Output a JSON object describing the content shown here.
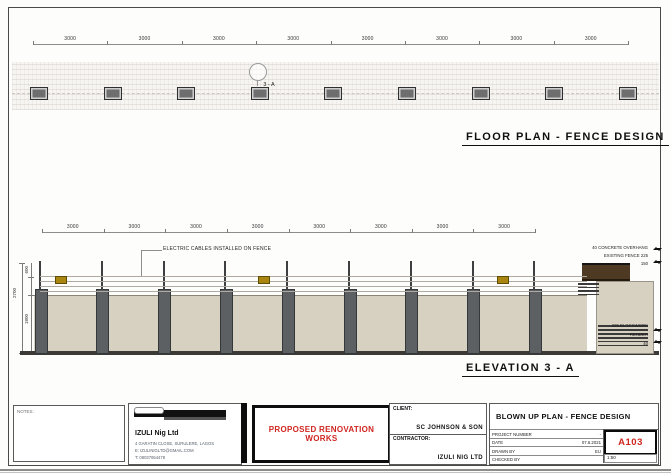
{
  "floor_plan": {
    "title": "FLOOR PLAN - FENCE DESIGN",
    "bay_dimensions": [
      "3000",
      "3000",
      "3000",
      "3000",
      "3000",
      "3000",
      "3000",
      "3000"
    ],
    "detail_marker": "3 - A",
    "post_count": 9
  },
  "elevation": {
    "title": "ELEVATION 3 - A",
    "bay_dimensions": [
      "3000",
      "3000",
      "3000",
      "3000",
      "3000",
      "3000",
      "3000",
      "3000"
    ],
    "cable_note": "ELECTRIC CABLES INSTALLED ON FENCE",
    "post_count": 9,
    "wire_count": 4,
    "sign_count": 3,
    "left_dimensions": {
      "overall": "2700",
      "cables": "600",
      "wall": "1800"
    },
    "right_annotations_top": [
      "40 CONCRETE OVERHANG",
      "EXISTING FENCE 225",
      "150"
    ],
    "right_annotations_bottom": [
      "225 BLOCKWORK",
      "RENDER",
      "40"
    ]
  },
  "title_block": {
    "notes_label": "NOTES:",
    "company": {
      "name": "IZULI Nig Ltd",
      "address": "4 GARATIN CLOSE, SURULERE, LAGOS",
      "line2": "E: IZULINIGLTD@GMAIL.COM",
      "line3": "T: 08037654478"
    },
    "stamp": "PROPOSED RENOVATION WORKS",
    "client_label": "CLIENT:",
    "client_name": "SC JOHNSON & SON",
    "contractor_label": "CONTRACTOR:",
    "contractor_name": "IZULI NIG LTD",
    "drawing_title": "BLOWN UP PLAN - FENCE DESIGN",
    "fields": [
      {
        "label": "PROJECT NUMBER",
        "value": "-"
      },
      {
        "label": "DATE",
        "value": "07.6.2021"
      },
      {
        "label": "DRAWN BY",
        "value": "EU"
      },
      {
        "label": "CHECKED BY",
        "value": ""
      }
    ],
    "sheet_number": "A103",
    "scale": "1:50"
  },
  "colors": {
    "wall": "#d7d1c2",
    "post": "#5d6063",
    "coping": "#4e3a22",
    "sign_yellow": "#a8860f",
    "stamp_red": "#d02620"
  }
}
